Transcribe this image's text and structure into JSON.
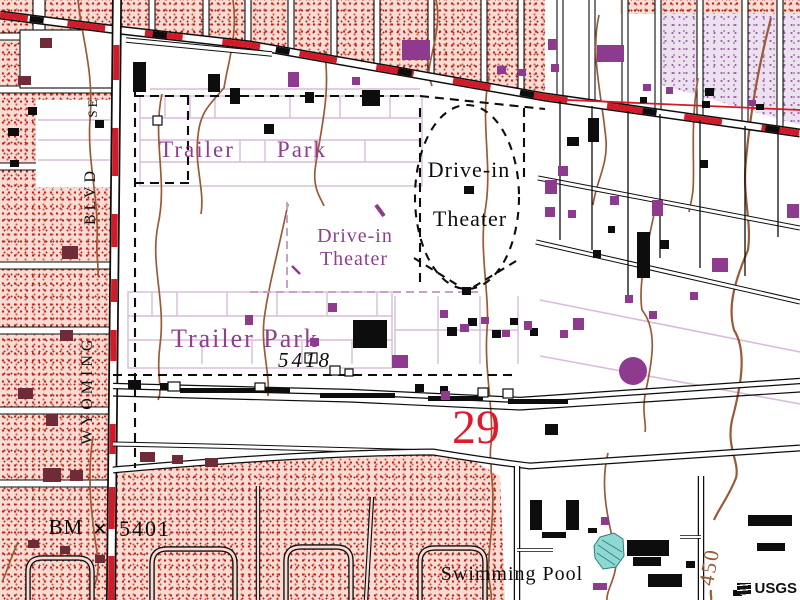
{
  "map": {
    "labels": {
      "trailer_park_top_word1": "Trailer",
      "trailer_park_top_word2": "Park",
      "trailer_park_bottom": "Trailer Park",
      "drive_in_theater_line1": "Drive-in",
      "drive_in_theater_line2": "Theater",
      "drive_in_theater_revised_line1": "Drive-in",
      "drive_in_theater_revised_line2": "Theater",
      "swimming_pool": "Swimming Pool"
    },
    "street_names": {
      "wyoming": "WYOMING",
      "blvd": "BLVD",
      "se": "SE"
    },
    "annotations": {
      "section_number": "29",
      "benchmark_prefix": "BM",
      "benchmark_symbol": "×",
      "benchmark_elevation": "5401",
      "spot_elevation": "5418",
      "contour_elevation": "450"
    },
    "watermark": "USGS",
    "colors": {
      "urban_tint": "#f8dcd3",
      "urban_dot": "#bf2318",
      "revised_tint": "#ece2ef",
      "revised_purple": "#8e3a8e",
      "contour_brown": "#9b5a36",
      "highway_red": "#d31a28",
      "section_red": "#dd1b2d",
      "water_cyan": "#8fd8d2",
      "label_purple": "#8e3f8e",
      "park_outline_purple": "#d9bcd9",
      "ink_black": "#0d0d0d"
    }
  }
}
